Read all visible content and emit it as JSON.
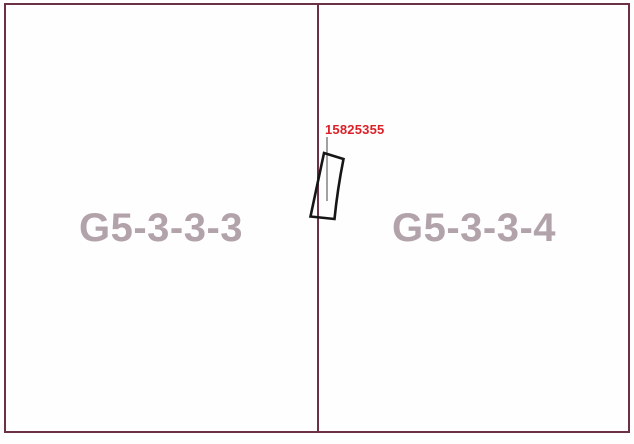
{
  "map": {
    "cells": [
      {
        "id": "G5-3-3-3",
        "label": "G5-3-3-3"
      },
      {
        "id": "G5-3-3-4",
        "label": "G5-3-3-4"
      }
    ],
    "feature": {
      "label": "15825355"
    },
    "colors": {
      "grid_border": "#6d3144",
      "cell_label": "#b2a3aa",
      "feature_label": "#dc2027",
      "feature_outline": "#161616",
      "leader_line": "#6f6f6f",
      "background": "#fefefe"
    }
  }
}
